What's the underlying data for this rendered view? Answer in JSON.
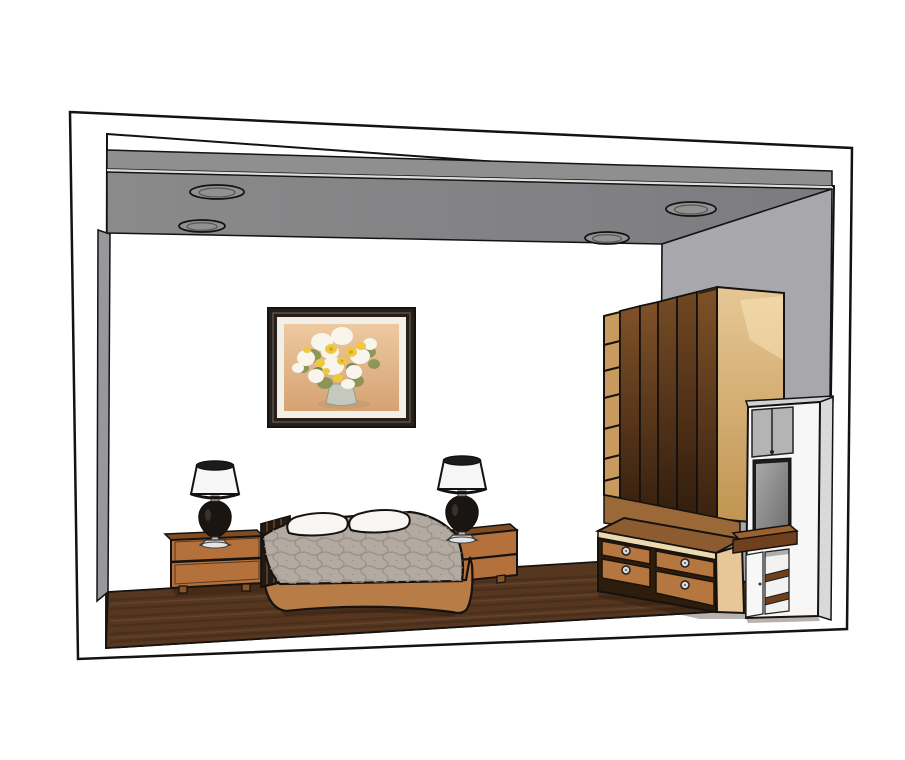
{
  "scene": {
    "room_type": "bedroom",
    "render_style": "3d-cutaway-model-render",
    "objects": [
      "ceiling with four recessed oval downlights",
      "framed painting of white and yellow flower bouquet",
      "double bed with patterned bedspread and two pillows",
      "left nightstand with table lamp",
      "right nightstand with table lamp",
      "five-door wardrobe with open shelf column",
      "four-drawer dresser with round knobs",
      "white tv cabinet unit with gray doors and open shelves",
      "dark wood plank floor"
    ]
  },
  "colors": {
    "outline": "#151210",
    "bg": "#ffffff",
    "frame_white": "#ffffff",
    "back_wall": "#ffffff",
    "left_wall": "#98979c",
    "right_wall": "#a8a7ac",
    "ceiling_fascia": "#8f8f8f",
    "ceiling_edge": "#dcdcdc",
    "ceiling_soffit": "#8a8a8a",
    "ceiling_soffit_deep": "#7c7b80",
    "downlight": "#919191",
    "downlight_ring": "#555555",
    "floor": "#56361f",
    "floor_streak_dark": "rgba(0,0,0,0.12)",
    "floor_streak_light": "rgba(255,255,255,0.07)",
    "painting_frame": "#27201a",
    "painting_bevel": "#58504a",
    "painting_mat": "#f2efe6",
    "art_bg_top": "#eec9a0",
    "art_bg_bottom": "#d5a273",
    "flower_white": "#f8f5ec",
    "flower_yellow": "#eec83e",
    "flower_yellow_deep": "#d9a826",
    "leaf_green": "#7e9150",
    "leaf_green_deep": "#5f7a3e",
    "vase": "#c3cdc8",
    "vase_shadow": "#c49a6b",
    "pillow": "#f7f6f2",
    "bedspread": "#b3aaa2",
    "bedspread_pattern": "#9a9087",
    "bed_skirt": "#b87c46",
    "headboard": "#241a14",
    "headboard_slat": "#6b4526",
    "nightstand_wood": "#b5713c",
    "nightstand_top": "#7e4b22",
    "nightstand_foot": "#8a5426",
    "lamp_shade": "#f6f6f6",
    "lamp_rim": "#1c1c1c",
    "lamp_body": "#1b1512",
    "lamp_metal": "#d6d6d6",
    "lamp_metal_light": "#e4e4e4",
    "wardrobe_door_top": "#7f5128",
    "wardrobe_door_bottom": "#3a2210",
    "wardrobe_shelf_col": "#c89a5e",
    "wardrobe_side_top": "#e6c795",
    "wardrobe_side_bottom": "#c09451",
    "wardrobe_top_edge": "#2f2313",
    "panel_brown": "#9b6838",
    "dresser_top": "#8c5c30",
    "dresser_trim": "#ecd9ad",
    "drawer_wood": "#b5773f",
    "drawer_gap": "#2e1c0d",
    "knob_silver": "#d9d9d9",
    "dresser_side": "#e6c795",
    "unit_white": "#f7f7f7",
    "unit_side": "#d9d9d9",
    "unit_top": "#d2d2d2",
    "unit_gray_doors": "#b4b4b4",
    "tv_frame": "#1c1c1c",
    "tv_screen_light": "#a9a9a9",
    "tv_screen_dark": "#6c6c6c",
    "counter_top": "#9b6130",
    "counter_front": "#6f401d",
    "shelf_board": "#6f3f1d",
    "shelf_inner_white": "#f2f2f2",
    "shadow": "rgba(35,20,8,0.33)"
  }
}
